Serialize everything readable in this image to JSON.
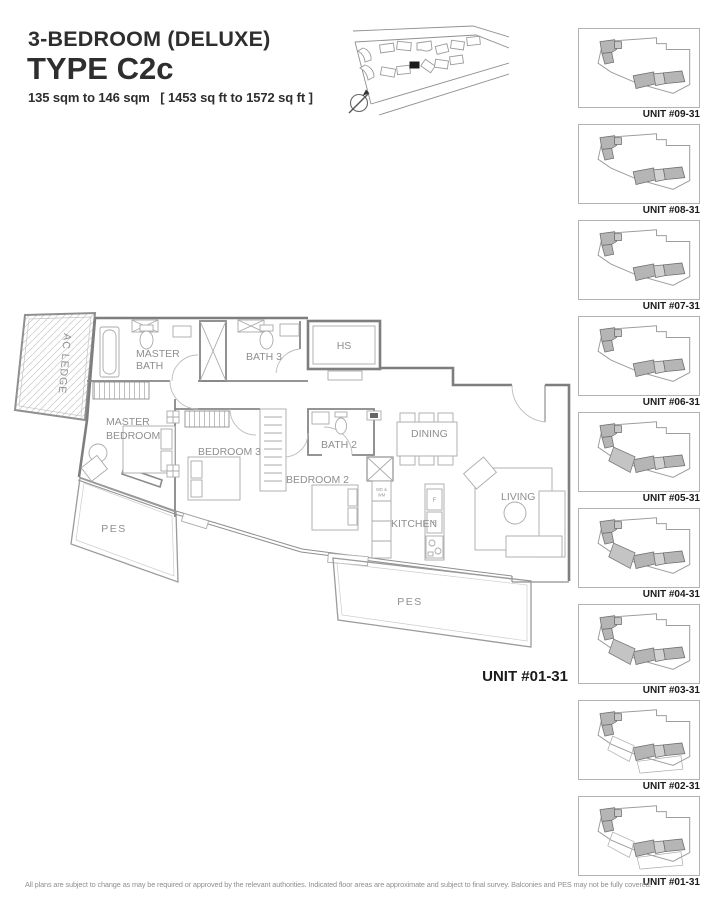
{
  "header": {
    "subtitle": "3-BEDROOM (DELUXE)",
    "title": "TYPE C2c",
    "area": "135 sqm to 146 sqm   [ 1453 sq ft to 1572 sq ft ]"
  },
  "plan": {
    "unit_label": "UNIT #01-31",
    "rooms": {
      "ac_ledge": "AC LEDGE",
      "master_bath_1": "MASTER",
      "master_bath_2": "BATH",
      "bath3": "BATH 3",
      "hs": "HS",
      "master_bedroom_1": "MASTER",
      "master_bedroom_2": "BEDROOM",
      "bedroom3": "BEDROOM 3",
      "bath2": "BATH 2",
      "dining": "DINING",
      "bedroom2": "BEDROOM 2",
      "kitchen": "KITCHEN",
      "living": "LIVING",
      "pes_left": "PES",
      "pes_bottom": "PES",
      "appliance_1": "WD &",
      "appliance_2": "WM",
      "fridge": "F"
    }
  },
  "units": [
    {
      "label": "UNIT #09-31"
    },
    {
      "label": "UNIT #08-31"
    },
    {
      "label": "UNIT #07-31"
    },
    {
      "label": "UNIT #06-31"
    },
    {
      "label": "UNIT #05-31"
    },
    {
      "label": "UNIT #04-31"
    },
    {
      "label": "UNIT #03-31"
    },
    {
      "label": "UNIT #02-31"
    },
    {
      "label": "UNIT #01-31"
    }
  ],
  "footer": {
    "disclaimer": "All plans are subject to change as may be required or approved by the relevant authorities. Indicated floor areas are approximate and subject to final survey. Balconies and PES may not be fully covered."
  },
  "colors": {
    "ink": "#2e2e2e",
    "plan_line": "#8f8f8f",
    "highlight_fill": "#b5b5b5"
  }
}
